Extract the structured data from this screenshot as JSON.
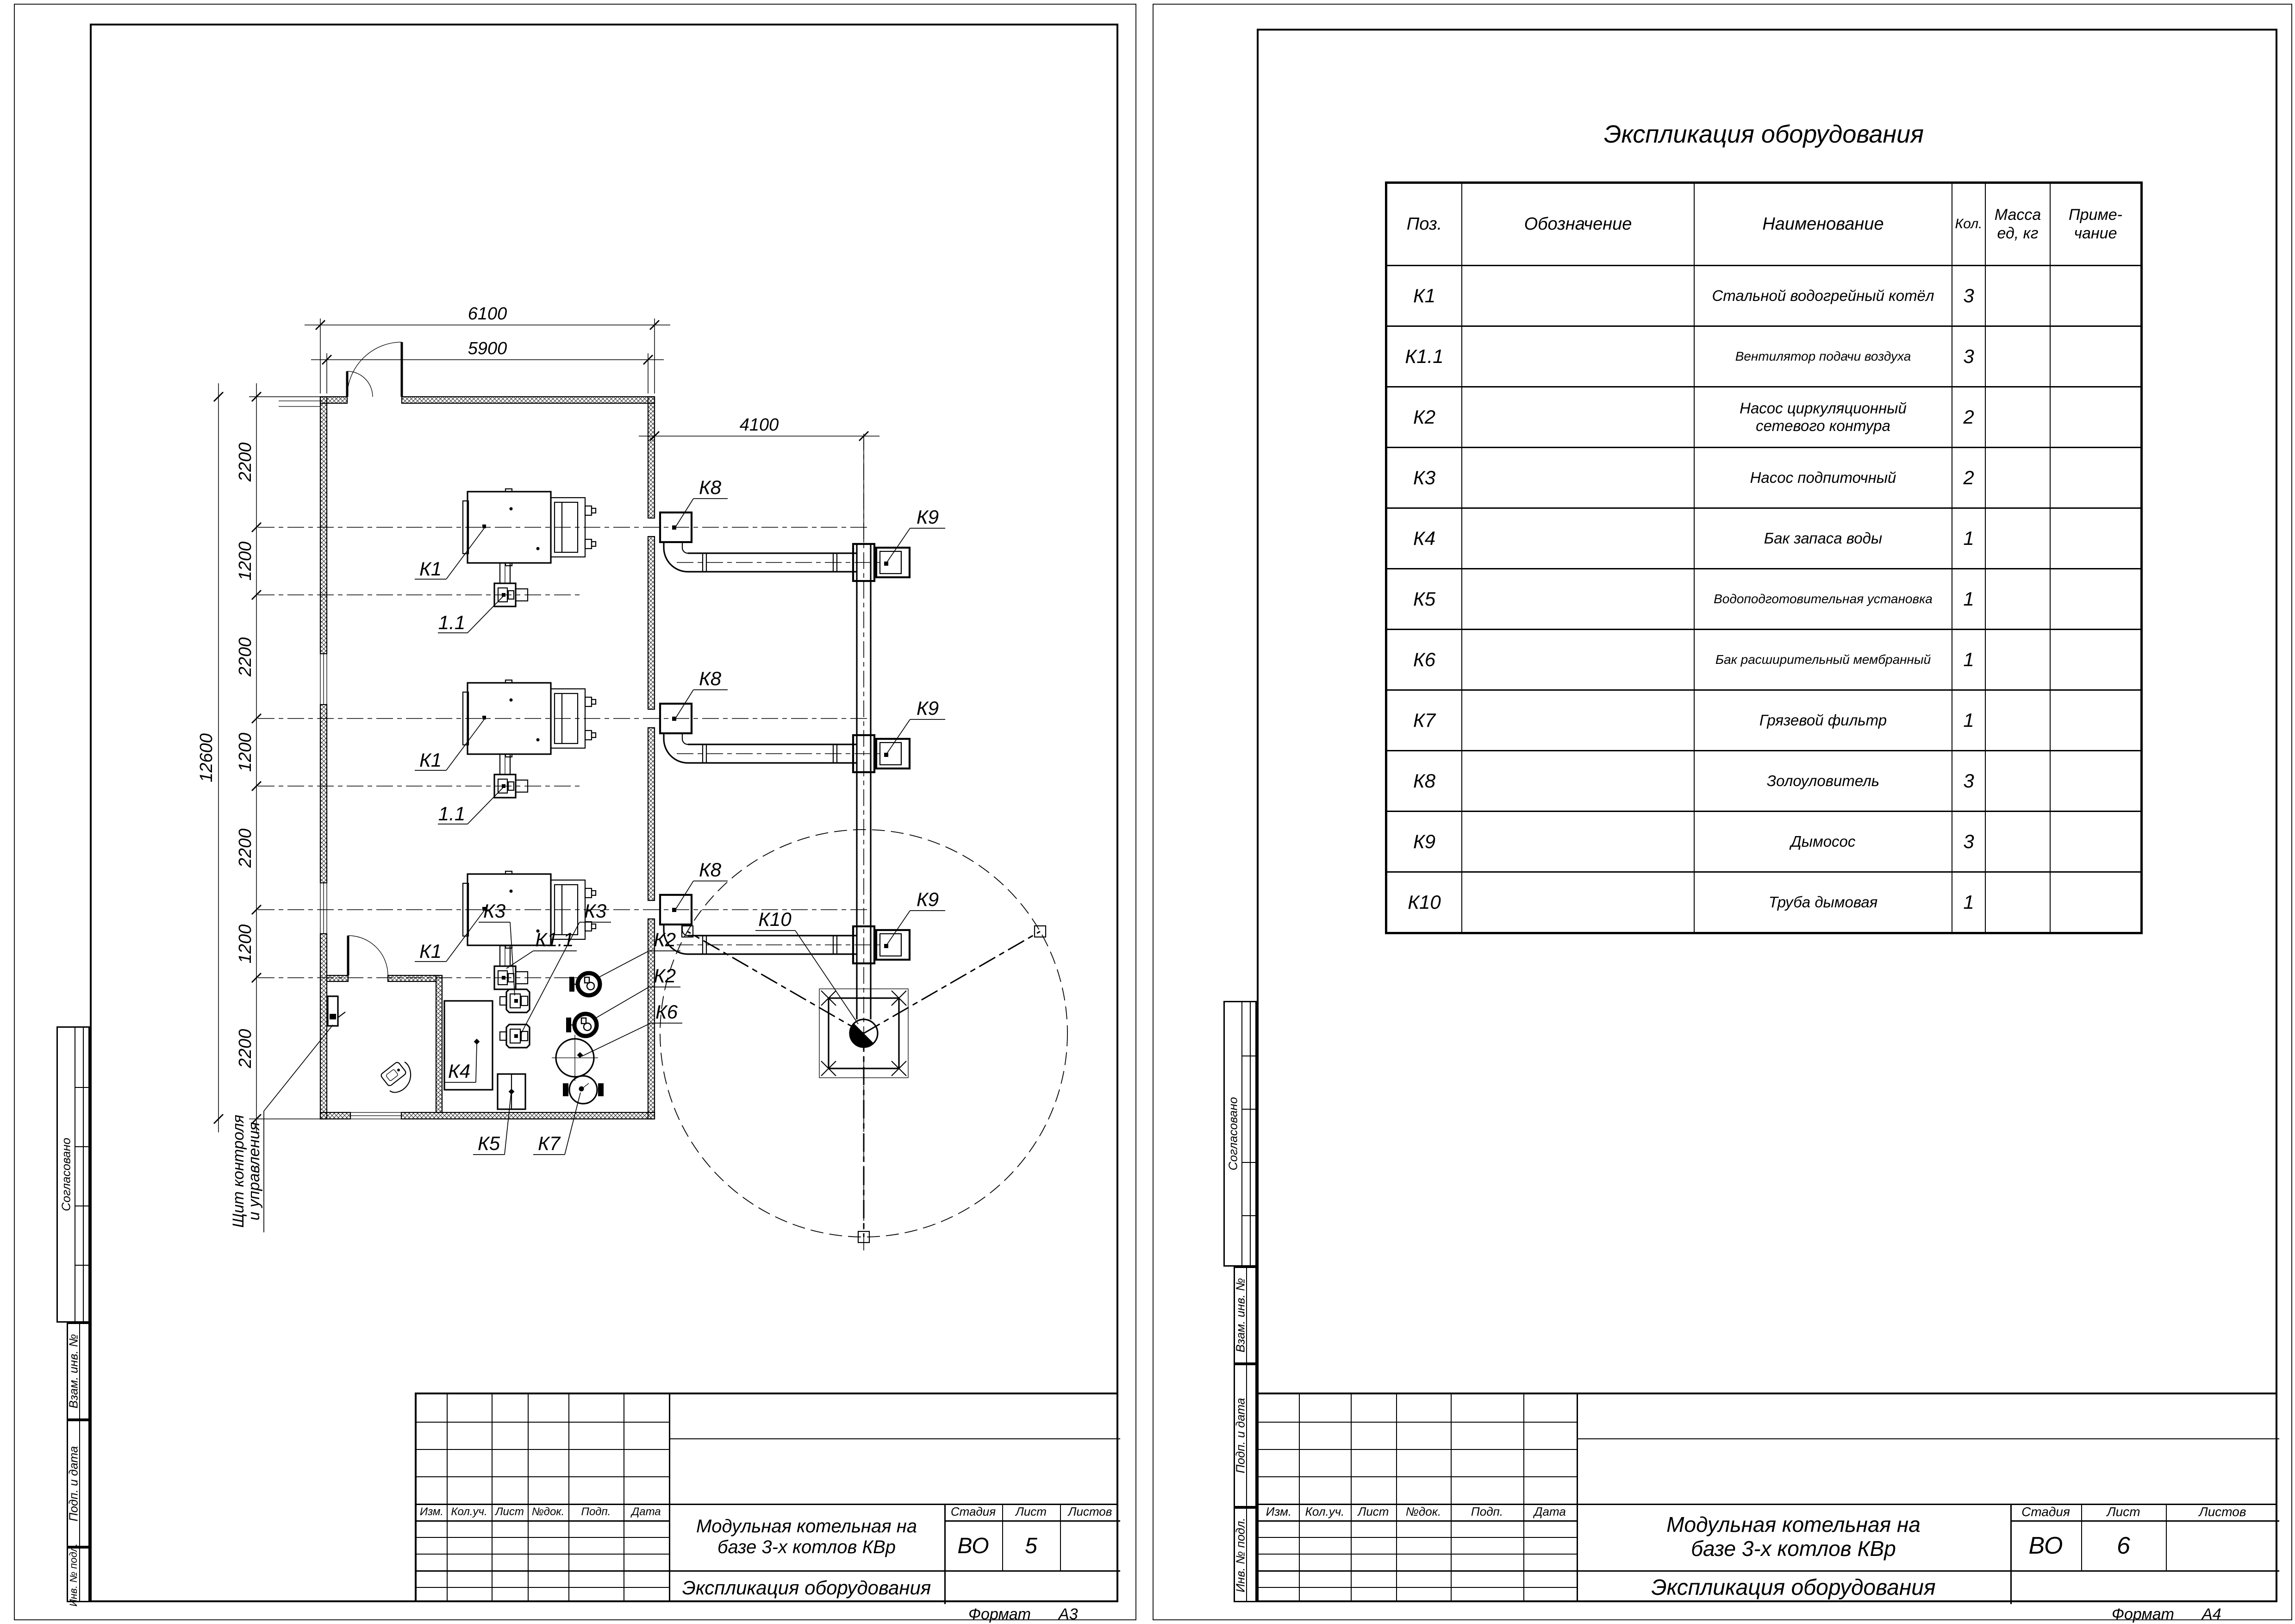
{
  "left_sheet": {
    "format_label": "Формат",
    "format_value": "А3",
    "stamps": [
      "Согласовано",
      "Взам. инв. №",
      "Подп. и дата",
      "Инв. № подл."
    ],
    "title_block": {
      "rev_headers": [
        "Изм.",
        "Кол.уч.",
        "Лист",
        "№док.",
        "Подп.",
        "Дата"
      ],
      "title_line1": "Модульная котельная на",
      "title_line2": "базе 3-х котлов КВр",
      "stage_label": "Стадия",
      "sheet_label": "Лист",
      "sheets_label": "Листов",
      "stage": "ВО",
      "sheet": "5",
      "sheets": "",
      "doc_name": "Экспликация оборудования"
    },
    "plan": {
      "dim_top_outer": "6100",
      "dim_top_inner": "5900",
      "dim_flue": "4100",
      "dim_left_total": "12600",
      "dim_left_segments": [
        "2200",
        "1200",
        "2200",
        "1200",
        "2200",
        "1200",
        "2200"
      ],
      "labels": {
        "boiler": "К1",
        "fan_short": "1.1",
        "fan_full": "К1.1",
        "ash_catcher": "К8",
        "smoke_exhauster": "К9",
        "chimney": "К10",
        "pump_network": "К2",
        "pump_makeup": "К3",
        "water_tank": "К4",
        "water_treatment": "К5",
        "expansion_tank": "К6",
        "dirt_filter": "К7",
        "panel_line1": "Щит контроля",
        "panel_line2": "и управления"
      }
    }
  },
  "right_sheet": {
    "format_label": "Формат",
    "format_value": "А4",
    "stamps": [
      "Согласовано",
      "Взам. инв. №",
      "Подп. и дата",
      "Инв. № подл."
    ],
    "table_title": "Экспликация оборудования",
    "table": {
      "headers": {
        "pos": "Поз.",
        "designation": "Обозначение",
        "name": "Наименование",
        "qty": "Кол.",
        "mass_l1": "Масса",
        "mass_l2": "ед, кг",
        "note_l1": "Приме-",
        "note_l2": "чание"
      },
      "rows": [
        {
          "pos": "К1",
          "designation": "",
          "name": "Стальной водогрейный котёл",
          "name2": "",
          "qty": "3",
          "mass": "",
          "note": ""
        },
        {
          "pos": "К1.1",
          "designation": "",
          "name": "Вентилятор подачи воздуха",
          "name2": "",
          "qty": "3",
          "mass": "",
          "note": ""
        },
        {
          "pos": "К2",
          "designation": "",
          "name": "Насос циркуляционный",
          "name2": "сетевого контура",
          "qty": "2",
          "mass": "",
          "note": ""
        },
        {
          "pos": "К3",
          "designation": "",
          "name": "Насос подпиточный",
          "name2": "",
          "qty": "2",
          "mass": "",
          "note": ""
        },
        {
          "pos": "К4",
          "designation": "",
          "name": "Бак запаса воды",
          "name2": "",
          "qty": "1",
          "mass": "",
          "note": ""
        },
        {
          "pos": "К5",
          "designation": "",
          "name": "Водоподготовительная установка",
          "name2": "",
          "qty": "1",
          "mass": "",
          "note": ""
        },
        {
          "pos": "К6",
          "designation": "",
          "name": "Бак расширительный мембранный",
          "name2": "",
          "qty": "1",
          "mass": "",
          "note": ""
        },
        {
          "pos": "К7",
          "designation": "",
          "name": "Грязевой фильтр",
          "name2": "",
          "qty": "1",
          "mass": "",
          "note": ""
        },
        {
          "pos": "К8",
          "designation": "",
          "name": "Золоуловитель",
          "name2": "",
          "qty": "3",
          "mass": "",
          "note": ""
        },
        {
          "pos": "К9",
          "designation": "",
          "name": "Дымосос",
          "name2": "",
          "qty": "3",
          "mass": "",
          "note": ""
        },
        {
          "pos": "К10",
          "designation": "",
          "name": "Труба дымовая",
          "name2": "",
          "qty": "1",
          "mass": "",
          "note": ""
        }
      ]
    },
    "title_block": {
      "rev_headers": [
        "Изм.",
        "Кол.уч.",
        "Лист",
        "№док.",
        "Подп.",
        "Дата"
      ],
      "title_line1": "Модульная котельная на",
      "title_line2": "базе 3-х котлов КВр",
      "stage_label": "Стадия",
      "sheet_label": "Лист",
      "sheets_label": "Листов",
      "stage": "ВО",
      "sheet": "6",
      "sheets": "",
      "doc_name": "Экспликация оборудования"
    }
  }
}
